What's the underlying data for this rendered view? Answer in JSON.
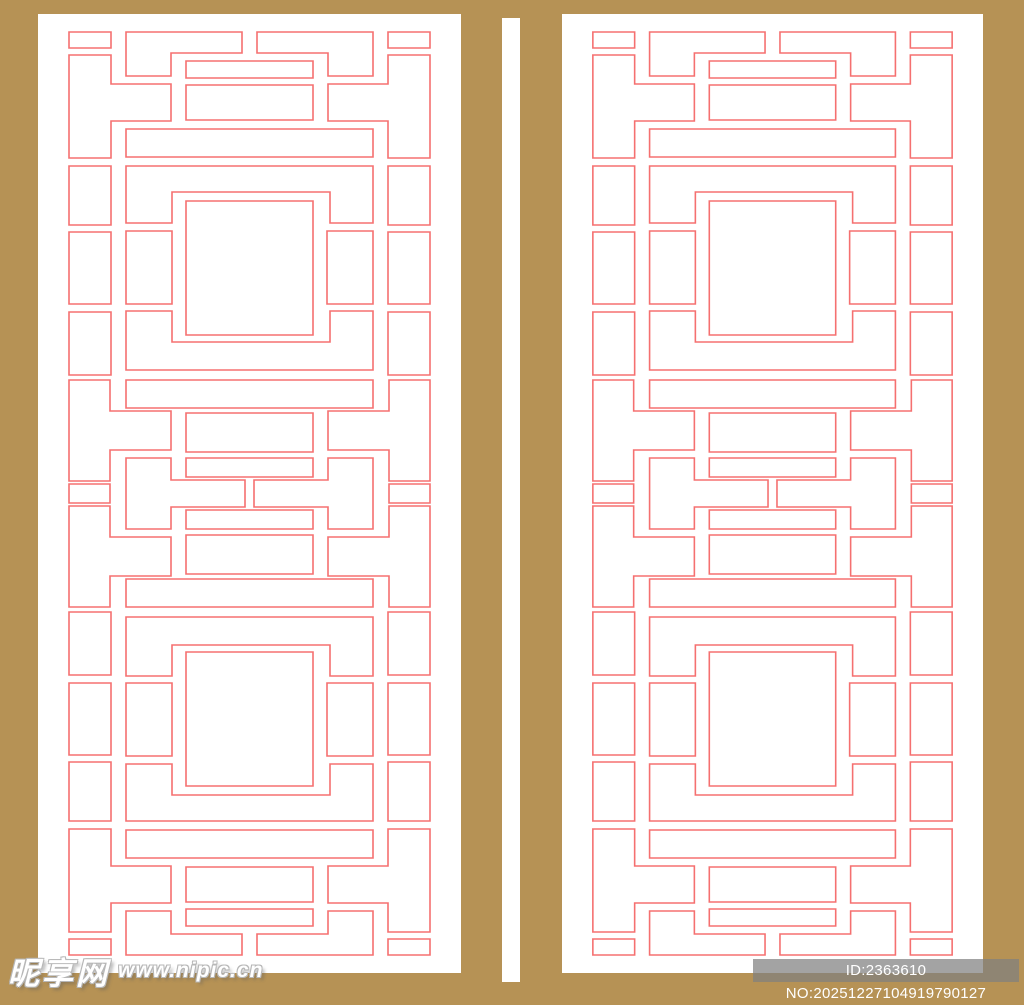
{
  "image": {
    "description": "Two identical traditional Chinese lattice window panels, red outline pattern on white, on a gold-tan frame background",
    "panel_count": 2
  },
  "colors": {
    "background": "#b69255",
    "panel": "#ffffff",
    "gap_stripe": "#ffffff",
    "line": "#f57070",
    "id_bar_bg": "rgba(127,127,127,0.72)",
    "id_text": "#ffffff",
    "watermark_text": "#ffffff"
  },
  "watermark": {
    "site_name": "昵享网",
    "site_url": "www.nipic.cn"
  },
  "id_badge": {
    "text": "ID:2363610 NO:20251227104919790127"
  },
  "pattern": {
    "width": 423,
    "height": 959,
    "stroke_width": 1.6,
    "pieces": [
      {
        "type": "rect",
        "x": 31,
        "y": 18,
        "w": 42,
        "h": 16,
        "mirrorH": true,
        "mirrorV": true
      },
      {
        "type": "poly",
        "points": [
          [
            31,
            41
          ],
          [
            73,
            41
          ],
          [
            73,
            70
          ],
          [
            133,
            70
          ],
          [
            133,
            107
          ],
          [
            73,
            107
          ],
          [
            73,
            144
          ],
          [
            31,
            144
          ]
        ],
        "mirrorH": true,
        "mirrorV": true
      },
      {
        "type": "poly",
        "points": [
          [
            88,
            18
          ],
          [
            204,
            18
          ],
          [
            204,
            39
          ],
          [
            133,
            39
          ],
          [
            133,
            62
          ],
          [
            88,
            62
          ]
        ],
        "mirrorH": true,
        "mirrorV": true
      },
      {
        "type": "rect",
        "x": 148,
        "y": 47,
        "w": 127,
        "h": 17,
        "mirrorV": true
      },
      {
        "type": "rect",
        "x": 148,
        "y": 71,
        "w": 127,
        "h": 35,
        "mirrorV": true
      },
      {
        "type": "rect",
        "x": 88,
        "y": 115,
        "w": 247,
        "h": 28,
        "mirrorV": true
      },
      {
        "type": "poly",
        "points": [
          [
            88,
            152
          ],
          [
            335,
            152
          ],
          [
            335,
            209
          ],
          [
            292,
            209
          ],
          [
            292,
            178
          ],
          [
            134,
            178
          ],
          [
            134,
            209
          ],
          [
            88,
            209
          ]
        ],
        "mirrorV": true
      },
      {
        "type": "rect",
        "x": 31,
        "y": 152,
        "w": 42,
        "h": 59,
        "mirrorH": true,
        "mirrorV": true
      },
      {
        "type": "rect",
        "x": 31,
        "y": 218,
        "w": 42,
        "h": 72,
        "mirrorH": true,
        "mirrorV": true
      },
      {
        "type": "rect",
        "x": 31,
        "y": 298,
        "w": 42,
        "h": 63,
        "mirrorH": true,
        "mirrorV": true
      },
      {
        "type": "rect",
        "x": 88,
        "y": 217,
        "w": 46,
        "h": 73,
        "mirrorH": true,
        "mirrorV": true
      },
      {
        "type": "rect",
        "x": 148,
        "y": 187,
        "w": 127,
        "h": 134,
        "mirrorV": true
      },
      {
        "type": "poly",
        "points": [
          [
            88,
            297
          ],
          [
            134,
            297
          ],
          [
            134,
            328
          ],
          [
            292,
            328
          ],
          [
            292,
            297
          ],
          [
            335,
            297
          ],
          [
            335,
            356
          ],
          [
            88,
            356
          ]
        ],
        "mirrorV": true
      },
      {
        "type": "rect",
        "x": 88,
        "y": 366,
        "w": 247,
        "h": 28,
        "mirrorV": true
      },
      {
        "type": "poly",
        "points": [
          [
            31,
            366
          ],
          [
            72,
            366
          ],
          [
            72,
            397
          ],
          [
            133,
            397
          ],
          [
            133,
            436
          ],
          [
            72,
            436
          ],
          [
            72,
            467
          ],
          [
            31,
            467
          ]
        ],
        "mirrorH": true,
        "mirrorV": true
      },
      {
        "type": "rect",
        "x": 31,
        "y": 470,
        "w": 41,
        "h": 19,
        "mirrorH": true
      },
      {
        "type": "poly",
        "points": [
          [
            88,
            444
          ],
          [
            133,
            444
          ],
          [
            133,
            466
          ],
          [
            207,
            466
          ],
          [
            207,
            493
          ],
          [
            133,
            493
          ],
          [
            133,
            515
          ],
          [
            88,
            515
          ]
        ],
        "mirrorH": true
      },
      {
        "type": "rect",
        "x": 148,
        "y": 399,
        "w": 127,
        "h": 39,
        "mirrorV": true
      },
      {
        "type": "rect",
        "x": 148,
        "y": 444,
        "w": 127,
        "h": 19,
        "mirrorV": true
      }
    ]
  }
}
